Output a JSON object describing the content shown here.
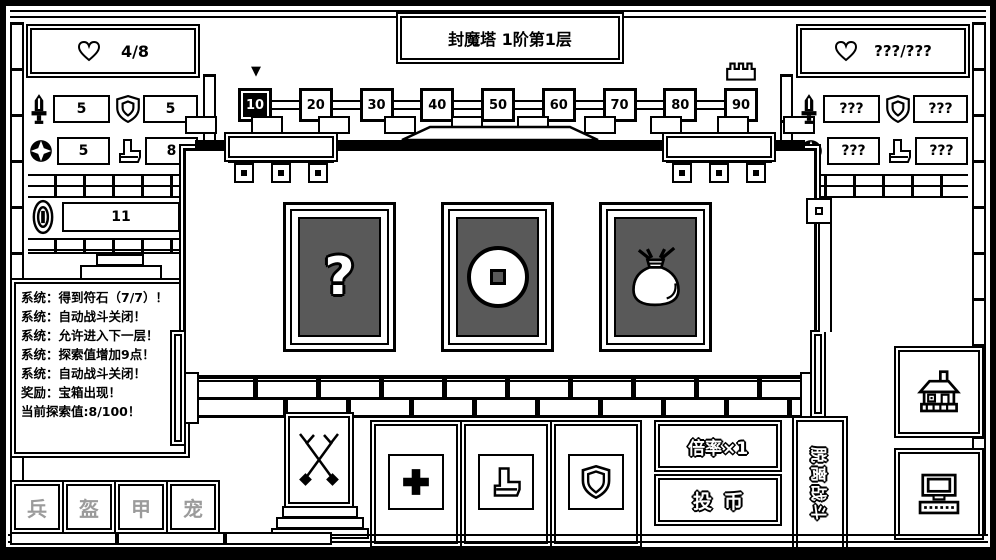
{
  "window": {
    "title": "封魔塔  1阶第1层"
  },
  "player_panel": {
    "hp": "4/8",
    "stats": [
      {
        "name": "attack",
        "value": "5"
      },
      {
        "name": "defense",
        "value": "5"
      },
      {
        "name": "crit",
        "value": "5"
      },
      {
        "name": "speed",
        "value": "8"
      }
    ],
    "coins": "11"
  },
  "enemy_panel": {
    "hp": "???/???",
    "stats": [
      {
        "name": "attack",
        "value": "???"
      },
      {
        "name": "defense",
        "value": "???"
      },
      {
        "name": "crit",
        "value": "???"
      },
      {
        "name": "speed",
        "value": "???"
      }
    ]
  },
  "floor_track": {
    "nodes": [
      "10",
      "20",
      "30",
      "40",
      "50",
      "60",
      "70",
      "80",
      "90"
    ],
    "current_node": "10",
    "goal_node": "90",
    "marker": "▼"
  },
  "message_log": {
    "lines": [
      "系统：得到符石（7/7）！",
      "系统：自动战斗关闭！",
      "系统：允许进入下一层！",
      "系统：探索值增加9点！",
      "系统：自动战斗关闭！",
      "奖励：宝箱出现！",
      "当前探索值:8/100！"
    ]
  },
  "cards": {
    "items": [
      {
        "name": "mystery-card",
        "icon": "question-mark",
        "glyph": "?"
      },
      {
        "name": "coin-card",
        "icon": "copper-coin"
      },
      {
        "name": "money-bag-card",
        "icon": "money-bag"
      }
    ]
  },
  "equipment_tabs": {
    "items": [
      {
        "label": "兵"
      },
      {
        "label": "盔"
      },
      {
        "label": "甲"
      },
      {
        "label": "宠"
      }
    ]
  },
  "buttons": {
    "multiplier": "倍率×1",
    "insert_coin": "投币",
    "leave_battle": "脱离战斗"
  },
  "colors": {
    "ink": "#000000",
    "paper": "#ffffff",
    "card_face": "#595959",
    "muted_text": "#9b9b9b"
  }
}
